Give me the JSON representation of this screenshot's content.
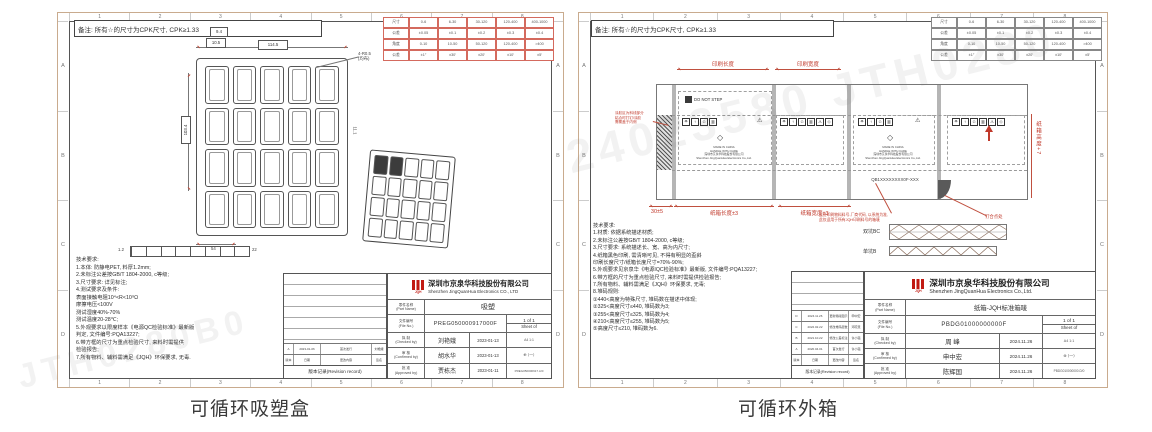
{
  "captions": {
    "left": "可循环吸塑盒",
    "right": "可循环外箱"
  },
  "watermark": {
    "w1": "24023580  JTH0280",
    "w2": "JTH0280B0"
  },
  "frame": {
    "cols": [
      "1",
      "2",
      "3",
      "4",
      "5",
      "6",
      "7",
      "8"
    ],
    "rows": [
      "A",
      "B",
      "C",
      "D"
    ]
  },
  "empty20": [
    "",
    "",
    "",
    "",
    "",
    "",
    "",
    "",
    "",
    "",
    "",
    "",
    "",
    "",
    "",
    "",
    "",
    "",
    "",
    ""
  ],
  "empty8": [
    "",
    "",
    "",
    "",
    "",
    "",
    "",
    ""
  ],
  "note_text": "备注: 所有☆的尺寸为CPK尺寸, CPK≥1.33",
  "tol_table": [
    "尺寸",
    "0-6",
    "6-30",
    "30-120",
    "120-400",
    "400-1000",
    "公差",
    "±0.05",
    "±0.1",
    "±0.2",
    "±0.3",
    "±0.4",
    "角度",
    "0-10",
    "10-50",
    "50-120",
    "120-400",
    ">400",
    "公差",
    "±1°",
    "±30′",
    "±20′",
    "±10′",
    "±5′"
  ],
  "left": {
    "dims": {
      "top": "114.5",
      "small1": "9.4",
      "small2": "10.5",
      "side_left": "103.4",
      "side_right": "11.1",
      "bottom": "54",
      "strip_left": "1.2",
      "strip_right": "22",
      "leader": "4-R0.5\n(均布)"
    },
    "notes": "技术要求:\n1.本体: 防静电PET, 料厚1.2mm;\n2.未标注公差按GB/T 1804-2000, c等级;\n3.尺寸要求: 详见标注;\n4.测试要求及条件:\n表面接触电阻10⁴<R<10⁹Ω\n摩擦电压<100V\n测试湿度40%-70%\n测试温度20-28℃;\n5.外观要求以限度样本《电源QC检验标准》最新版\n判定, 文件编号:PQA13227;\n6.带方框的尺寸为重点检验尺寸, 来料时需提供\n检验报告;\n7.所有物料、辅料需满足《JQH》环保要求, 无毒.",
    "title": {
      "logo": "JQH",
      "company_cn": "深圳市京泉华科技股份有限公司",
      "company_en": "Shenzhen JingQuanHua Electronics CO., LTD",
      "part_label": "零件名称\n(Part Name)",
      "part": "吸塑",
      "file_label": "文件编号\n(File No.)",
      "file": "PREG050000917000F",
      "pages": "1 of 1",
      "sheet_label": "Sheet of",
      "checked_label": "拟 制\n(Checked by)",
      "checked": "刘艳娥",
      "checked_date": "2023-01-13",
      "confirmed_label": "审 核\n(Confirmed by)",
      "confirmed": "胡水华",
      "confirmed_date": "2023-01-13",
      "approved_label": "批 准\n(Approved by)",
      "approved": "贾栋杰",
      "approved_date": "2023-01-11",
      "extra1": "A4  1:1",
      "extra2": "⊕ ⟨一⟩",
      "code": "PREG050000917.A/0",
      "record": "版本记录(Revision record)",
      "rev_head": [
        "版本",
        "日期",
        "更改内容",
        "签名"
      ],
      "rev_rows": [
        {
          "rev": "A",
          "date": "2023-01-06",
          "desc": "首次发行",
          "by": "刘艳娥"
        }
      ]
    }
  },
  "right": {
    "box": {
      "print_len": "印刷长度",
      "print_wid": "印刷宽度",
      "flap_dim": "30±5",
      "len_dim": "纸箱长度±3",
      "wid_dim": "纸箱宽度±3",
      "height_dim": "纸箱高度+7",
      "do_not_step": "DO NOT STEP",
      "mic": "MADE IN CHINA\nHANDLE WITH CARE\n深圳市京泉华科技股份有限公司\nShenzhen JingQuanHua Electronics Co.,Ltd.",
      "qb_code": "QB1XXXXXXXX0F-XXX",
      "left_note": "涂胶区为斜线部分\n粘合时打钉/涂胶\n需覆盖于内侧",
      "bottom_note": "此处印刷物料料号-厂商代码, 以系统为准,\n此仅适用于所有JQH印刷料号的箱唛",
      "nail_note": "钉合点处",
      "icons_p1": [
        "☂",
        "↑",
        "♲",
        "▥"
      ],
      "icons_p2": [
        "☂",
        "↑",
        "♲",
        "▥",
        "⚠",
        "◇"
      ],
      "icons_p3": [
        "☂",
        "↑",
        "♲",
        "▥"
      ],
      "icons_p4": [
        "☂",
        "↑",
        "♲",
        "▥",
        "⚠",
        "◇"
      ],
      "warn": "⚠"
    },
    "flutes": {
      "bc": "双坑BC",
      "b": "单坑B"
    },
    "notes": "技术要求:\n1.材质: 依据系统描述材质;\n2.未标注公差按GB/T 1804-2000, c等级;\n3.尺寸要求: 系统描述长、宽、高为内尺寸;\n4.纸箱黑色印刷, 需清晰可见, 不得有明显的歪斜\n印刷长度尺寸/纸箱长度尺寸=70%-90%;\n5.外观要求见京泉华《电源IQC检验标准》最新版, 文件编号:PQA13227;\n6.带方框的尺寸为重点检验尺寸, 来料时需提供检验报告;\n7.所有物料、辅料需满足《JQH》环保要求, 无毒;\n8.堆码规则:\n①440<高度为特殊尺寸, 堆码数在描述中体现;\n②325<高度尺寸≤440, 堆码数为3;\n③255<高度尺寸≤325, 堆码数为4;\n④210<高度尺寸≤255, 堆码数为5;\n⑤高度尺寸≤210, 堆码数为6.",
    "title": {
      "logo": "JQH",
      "company_cn": "深圳市京泉华科技股份有限公司",
      "company_en": "Shenzhen JingQuanHua Electronics Co.,Ltd.",
      "part_label": "零件名称\n(Part Name)",
      "part": "纸箱-JQH标准箱唛",
      "file_label": "文件编号\n(File No.)",
      "file": "PBDG01000000000F",
      "pages": "1 of 1",
      "sheet_label": "Sheet of",
      "checked_label": "拟 制\n(Checked by)",
      "checked": "周 峰",
      "checked_date": "2024.11.26",
      "confirmed_label": "审 核\n(Confirmed by)",
      "confirmed": "申中宏",
      "confirmed_date": "2024.11.26",
      "approved_label": "批 准\n(Approved by)",
      "approved": "陈辉国",
      "approved_date": "2024.11.26",
      "extra1": "A4  1:1",
      "extra2": "⊕ ⟨一⟩",
      "code": "PBDG010000000.D/0",
      "record": "版本记录(Revision record)",
      "rev_head": [
        "版本",
        "日期",
        "更改内容",
        "签名"
      ],
      "rev_rows": [
        {
          "rev": "D",
          "date": "2024.11.26",
          "desc": "更新箱唛图示",
          "by": "申中宏"
        },
        {
          "rev": "C",
          "date": "2022.02.22",
          "desc": "修改堆码层数",
          "by": "邓晓慧"
        },
        {
          "rev": "B",
          "date": "2021.10.22",
          "desc": "修改公差标注",
          "by": "许小强"
        },
        {
          "rev": "A",
          "date": "2020.04.01",
          "desc": "首次发行",
          "by": "许小强"
        }
      ]
    }
  }
}
